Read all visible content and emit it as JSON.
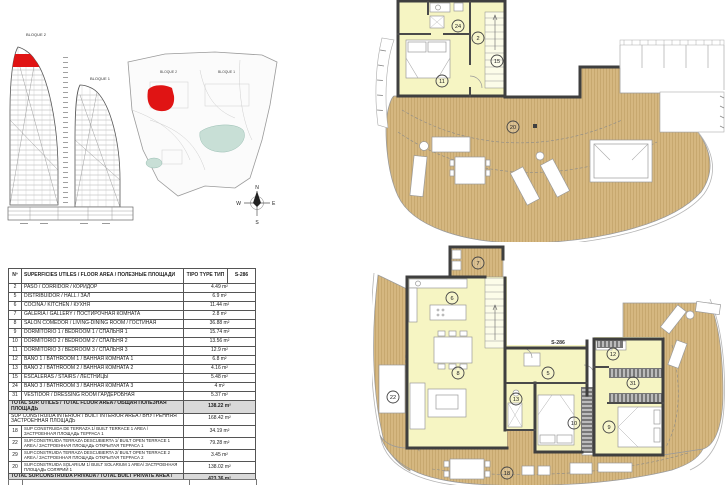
{
  "meta": {
    "type_code": "S-286"
  },
  "colors": {
    "highlight_red": "#e01414",
    "room_yellow": "#f6f5c3",
    "wood_deck": "#d5b780",
    "pool_teal": "#c8dfd6",
    "wall_dark": "#3f3f3f",
    "table_total_gray": "#d9d9d9"
  },
  "left_panel": {
    "elevation": {
      "bloque2_label": "BLOQUE 2",
      "bloque1_label": "BLOQUE 1"
    },
    "site": {
      "bloque2_label": "BLOQUE 2",
      "bloque1_label": "BLOQUE 1"
    },
    "compass": {
      "n": "N",
      "s": "S",
      "e": "E",
      "w": "W"
    }
  },
  "area_table": {
    "header": {
      "num": "Nº",
      "desc": "SUPERFICIES UTILES / FLOOR AREA / ПОЛЕЗНЫЕ ПЛОЩАДИ",
      "tipo": "TIPO TYPE ТИП",
      "type_code": "S-286"
    },
    "rows": [
      {
        "kind": "room",
        "num": "2",
        "desc": "PASO / CORRIDOR / КОРИДОР",
        "value": "4.49 m²"
      },
      {
        "kind": "room",
        "num": "5",
        "desc": "DISTRIBUIDOR /  HALL / ЗАЛ",
        "value": "6.9 m²"
      },
      {
        "kind": "room",
        "num": "6",
        "desc": "COCINA / KITCHEN / КУХНЯ",
        "value": "11.44 m²"
      },
      {
        "kind": "room",
        "num": "7",
        "desc": "GALERÍA / GALLERY / ПОСТИРОЧНАЯ КОМНАТА",
        "value": "2.8 m²"
      },
      {
        "kind": "room",
        "num": "8",
        "desc": "SALÓN COMEDOR  / LIVING-DINING ROOM / ГОСТИНАЯ",
        "value": "36.88 m²"
      },
      {
        "kind": "room",
        "num": "9",
        "desc": "DORMITORIO 1 / BEDROOM 1 / СПАЛЬНЯ 1",
        "value": "15.74 m²"
      },
      {
        "kind": "room",
        "num": "10",
        "desc": "DORMITORIO 2 / BEDROOM 2 / СПАЛЬНЯ 2",
        "value": "13.56 m²"
      },
      {
        "kind": "room",
        "num": "11",
        "desc": "DORMITORIO 3 / BEDROOM 3 / СПАЛЬНЯ 3",
        "value": "12.9 m²"
      },
      {
        "kind": "room",
        "num": "12",
        "desc": "BAÑO 1 / BATHROOM 1 / ВАННАЯ КОМНАТА 1",
        "value": "6.8 m²"
      },
      {
        "kind": "room",
        "num": "13",
        "desc": "BAÑO 2 / BATHROOM 2 / ВАННАЯ КОМНАТА 2",
        "value": "4.16 m²"
      },
      {
        "kind": "room",
        "num": "15",
        "desc": "ESCALERAS / STAIRS / ЛЕСТНИЦЫ",
        "value": "5.48 m²"
      },
      {
        "kind": "room",
        "num": "24",
        "desc": "BAÑO 3 / BATHROOM 3 / ВАННАЯ КОМНАТА 3",
        "value": "4 m²"
      },
      {
        "kind": "room",
        "num": "31",
        "desc": "VESTIDOR / DRESSING ROOM  ГАРДЕРОБНАЯ",
        "value": "5.37 m²"
      },
      {
        "kind": "total",
        "desc": "TOTAL SUP. UTILES / TOTAL FLOOR AREA / ОБЩАЯ ПОЛЕЗНАЯ ПЛОЩАДЬ",
        "value": "138.22 m²"
      },
      {
        "kind": "span",
        "desc": "SUP CONSTRUIDA INTERIOR / BUILT INTERIOR AREA / ВНУТРЕННЯЯ ЗАСТРОЕННАЯ ПЛОЩАДЬ",
        "value": "168.42 m²"
      },
      {
        "kind": "sub",
        "num": "18",
        "desc": "SUP CONSTRUIDA  DE TERRAZA 1/ BUILT TERRACE 1 AREA / ЗАСТРОЕННАЯ ПЛОЩАДЬ ТЕРРАСА 1",
        "value": "34.19 m²"
      },
      {
        "kind": "sub",
        "num": "22",
        "desc": "SUP.CONSTRUIDA TERRAZA DESCUBIERTA 1/ BUILT OPEN TERRACE 1 AREA /  ЗАСТРОЕННАЯ ПЛОЩАДЬ ОТКРЫТАЯ ТЕРРАСА  1",
        "value": "79.28 m²"
      },
      {
        "kind": "sub",
        "num": "29",
        "desc": "SUP.CONSTRUIDA TERRAZA DESCUBIERTA 2/ BUILT OPEN TERRACE 2 AREA /  ЗАСТРОЕННАЯ ПЛОЩАДЬ ОТКРЫТАЯ ТЕРРАСА  2",
        "value": "3.45 m²"
      },
      {
        "kind": "sub",
        "num": "20",
        "desc": "SUP.CONSTRUIDA SOLARIUM 1/ BUILT SOLARIUM 1 AREA/ ЗАСТРОЕННАЯ ПЛОЩАДЬ СОЛЯРИЙ  1",
        "value": "138.02 m²"
      },
      {
        "kind": "grand",
        "desc": "TOTAL SUP.CONSTRUIDA PRIVADA / TOTAL  BUILT PRIVATE AREA / ВНУТРЕННЯЯ ЗАСТРОЕННАЯ ПЛОЩАДЬ",
        "value": "423.36 m²"
      }
    ]
  },
  "plans": {
    "top": {
      "markers": [
        "24",
        "2",
        "15",
        "11",
        "20"
      ]
    },
    "bottom": {
      "markers": [
        "7",
        "6",
        "8",
        "22",
        "5",
        "13",
        "10",
        "12",
        "31",
        "9",
        "18"
      ],
      "type_label": "S-286"
    }
  }
}
